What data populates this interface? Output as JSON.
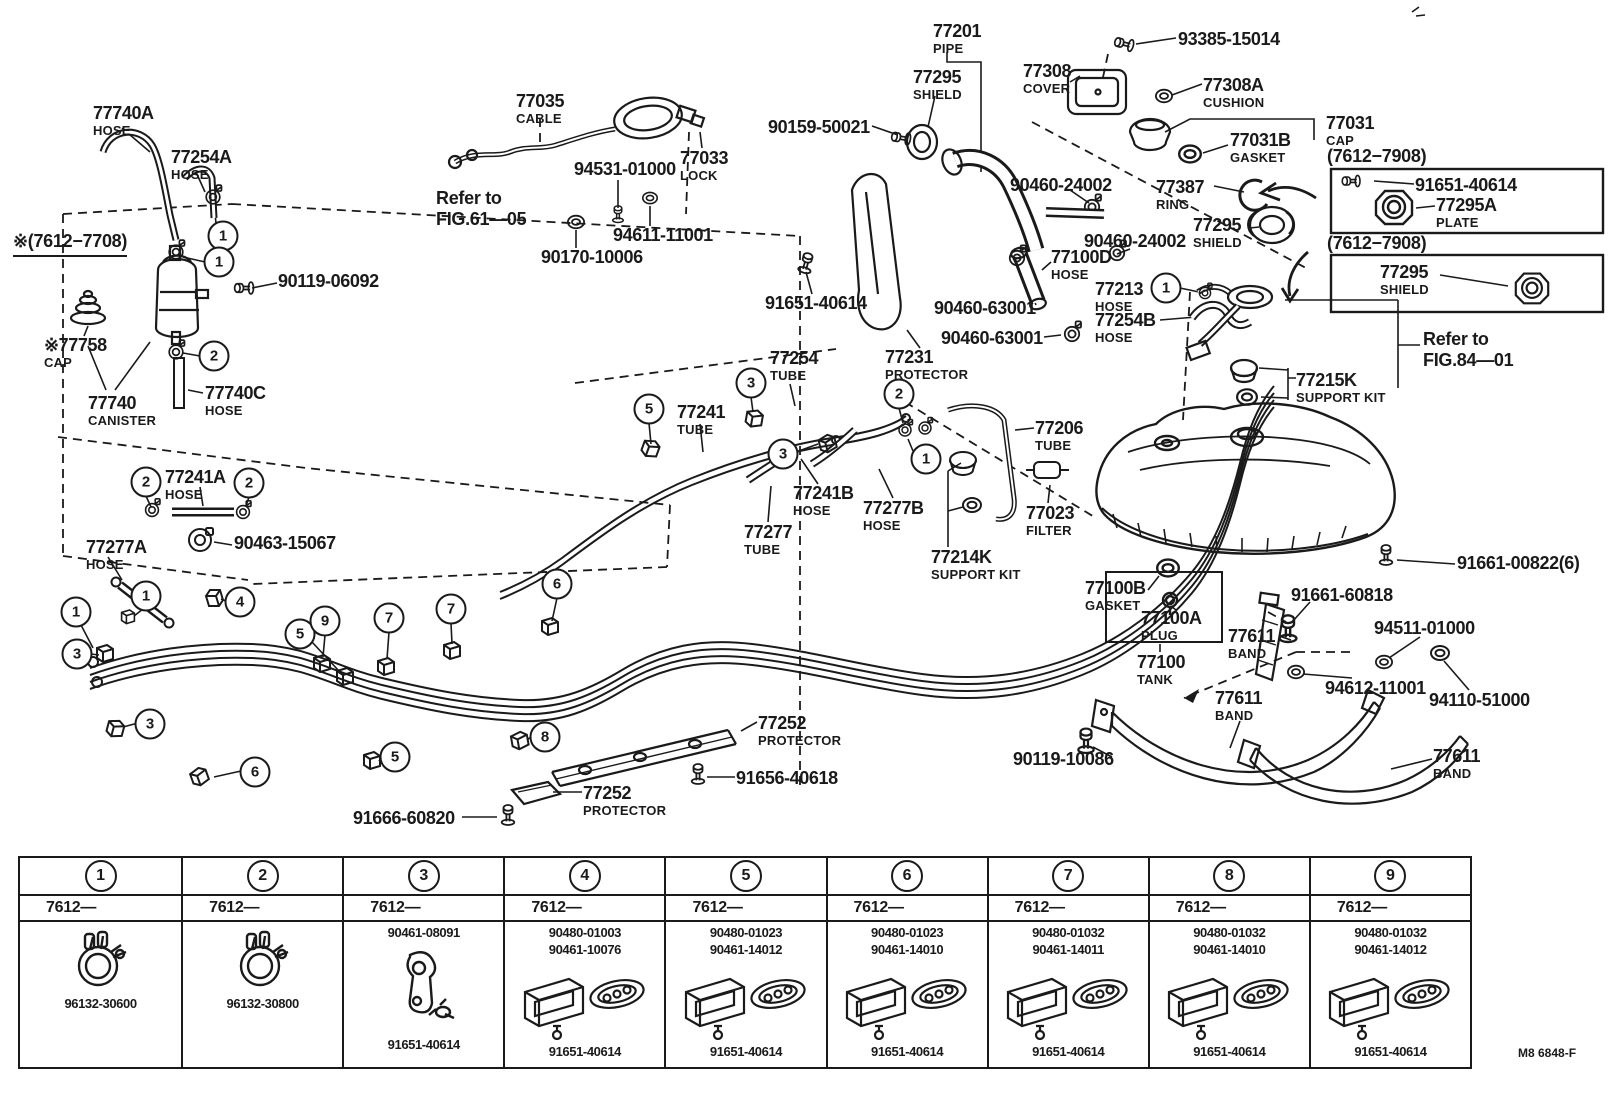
{
  "meta": {
    "figure_code": "M8 6848-F"
  },
  "colors": {
    "ink": "#1a1a1a",
    "background": "#ffffff"
  },
  "notes": [
    {
      "lines": [
        "※(7612−7708)"
      ],
      "x": 13,
      "y": 231,
      "underline": true
    },
    {
      "lines": [
        "Refer to",
        "FIG.61—05"
      ],
      "x": 436,
      "y": 188,
      "underline": false
    },
    {
      "lines": [
        "Refer to",
        "FIG.84—01"
      ],
      "x": 1423,
      "y": 329,
      "underline": false
    },
    {
      "lines": [
        "(7612−7908)"
      ],
      "x": 1327,
      "y": 146,
      "underline": false
    },
    {
      "lines": [
        "(7612−7908)"
      ],
      "x": 1327,
      "y": 233,
      "underline": false
    }
  ],
  "callouts": [
    {
      "n": "77740A",
      "t": "HOSE",
      "x": 93,
      "y": 104
    },
    {
      "n": "77254A",
      "t": "HOSE",
      "x": 171,
      "y": 148
    },
    {
      "n": "90119-06092",
      "t": "",
      "x": 278,
      "y": 272
    },
    {
      "n": "※77758",
      "t": "CAP",
      "x": 44,
      "y": 336
    },
    {
      "n": "77740",
      "t": "CANISTER",
      "x": 88,
      "y": 394
    },
    {
      "n": "77740C",
      "t": "HOSE",
      "x": 205,
      "y": 384
    },
    {
      "n": "77241A",
      "t": "HOSE",
      "x": 165,
      "y": 468
    },
    {
      "n": "90463-15067",
      "t": "",
      "x": 234,
      "y": 534
    },
    {
      "n": "77277A",
      "t": "HOSE",
      "x": 86,
      "y": 538
    },
    {
      "n": "77035",
      "t": "CABLE",
      "x": 516,
      "y": 92
    },
    {
      "n": "94531-01000",
      "t": "",
      "x": 574,
      "y": 160
    },
    {
      "n": "77033",
      "t": "LOCK",
      "x": 680,
      "y": 149
    },
    {
      "n": "94611-11001",
      "t": "",
      "x": 613,
      "y": 226
    },
    {
      "n": "90170-10006",
      "t": "",
      "x": 541,
      "y": 248
    },
    {
      "n": "77201",
      "t": "PIPE",
      "x": 933,
      "y": 22
    },
    {
      "n": "77295",
      "t": "SHIELD",
      "x": 913,
      "y": 68
    },
    {
      "n": "90159-50021",
      "t": "",
      "x": 768,
      "y": 118
    },
    {
      "n": "77308",
      "t": "COVER",
      "x": 1023,
      "y": 62
    },
    {
      "n": "93385-15014",
      "t": "",
      "x": 1178,
      "y": 30
    },
    {
      "n": "77308A",
      "t": "CUSHION",
      "x": 1203,
      "y": 76
    },
    {
      "n": "77031",
      "t": "CAP",
      "x": 1326,
      "y": 114
    },
    {
      "n": "77031B",
      "t": "GASKET",
      "x": 1230,
      "y": 131
    },
    {
      "n": "91651-40614",
      "t": "",
      "x": 1415,
      "y": 176
    },
    {
      "n": "77295A",
      "t": "PLATE",
      "x": 1436,
      "y": 196
    },
    {
      "n": "77387",
      "t": "RING",
      "x": 1156,
      "y": 178
    },
    {
      "n": "77295",
      "t": "SHIELD",
      "x": 1193,
      "y": 216
    },
    {
      "n": "77295",
      "t": "SHIELD",
      "x": 1380,
      "y": 263
    },
    {
      "n": "90460-24002",
      "t": "",
      "x": 1010,
      "y": 176
    },
    {
      "n": "90460-24002",
      "t": "",
      "x": 1084,
      "y": 232
    },
    {
      "n": "77100D",
      "t": "HOSE",
      "x": 1051,
      "y": 248
    },
    {
      "n": "77213",
      "t": "HOSE",
      "x": 1095,
      "y": 280
    },
    {
      "n": "77254B",
      "t": "HOSE",
      "x": 1095,
      "y": 311
    },
    {
      "n": "91651-40614",
      "t": "",
      "x": 765,
      "y": 294
    },
    {
      "n": "90460-63001",
      "t": "",
      "x": 934,
      "y": 299
    },
    {
      "n": "90460-63001",
      "t": "",
      "x": 941,
      "y": 329
    },
    {
      "n": "77231",
      "t": "PROTECTOR",
      "x": 885,
      "y": 348
    },
    {
      "n": "77215K",
      "t": "SUPPORT KIT",
      "x": 1296,
      "y": 371
    },
    {
      "n": "77254",
      "t": "TUBE",
      "x": 770,
      "y": 349
    },
    {
      "n": "77241",
      "t": "TUBE",
      "x": 677,
      "y": 403
    },
    {
      "n": "77206",
      "t": "TUBE",
      "x": 1035,
      "y": 419
    },
    {
      "n": "77241B",
      "t": "HOSE",
      "x": 793,
      "y": 484
    },
    {
      "n": "77277B",
      "t": "HOSE",
      "x": 863,
      "y": 499
    },
    {
      "n": "77023",
      "t": "FILTER",
      "x": 1026,
      "y": 504
    },
    {
      "n": "77277",
      "t": "TUBE",
      "x": 744,
      "y": 523
    },
    {
      "n": "77214K",
      "t": "SUPPORT KIT",
      "x": 931,
      "y": 548
    },
    {
      "n": "91661-00822(6)",
      "t": "",
      "x": 1457,
      "y": 554
    },
    {
      "n": "77100B",
      "t": "GASKET",
      "x": 1085,
      "y": 579
    },
    {
      "n": "77100A",
      "t": "PLUG",
      "x": 1141,
      "y": 609
    },
    {
      "n": "91661-60818",
      "t": "",
      "x": 1291,
      "y": 586
    },
    {
      "n": "77611",
      "t": "BAND",
      "x": 1228,
      "y": 627
    },
    {
      "n": "94511-01000",
      "t": "",
      "x": 1374,
      "y": 619
    },
    {
      "n": "77100",
      "t": "TANK",
      "x": 1137,
      "y": 653
    },
    {
      "n": "94612-11001",
      "t": "",
      "x": 1325,
      "y": 679
    },
    {
      "n": "94110-51000",
      "t": "",
      "x": 1429,
      "y": 691
    },
    {
      "n": "77611",
      "t": "BAND",
      "x": 1215,
      "y": 689
    },
    {
      "n": "90119-10086",
      "t": "",
      "x": 1013,
      "y": 750
    },
    {
      "n": "77611",
      "t": "BAND",
      "x": 1433,
      "y": 747
    },
    {
      "n": "77252",
      "t": "PROTECTOR",
      "x": 758,
      "y": 714
    },
    {
      "n": "91656-40618",
      "t": "",
      "x": 736,
      "y": 769
    },
    {
      "n": "77252",
      "t": "PROTECTOR",
      "x": 583,
      "y": 784
    },
    {
      "n": "91666-60820",
      "t": "",
      "x": 353,
      "y": 809
    }
  ],
  "circles": [
    {
      "n": "1",
      "x": 223,
      "y": 236
    },
    {
      "n": "1",
      "x": 219,
      "y": 262
    },
    {
      "n": "2",
      "x": 214,
      "y": 356
    },
    {
      "n": "2",
      "x": 146,
      "y": 482
    },
    {
      "n": "2",
      "x": 249,
      "y": 483
    },
    {
      "n": "1",
      "x": 146,
      "y": 596
    },
    {
      "n": "1",
      "x": 76,
      "y": 612
    },
    {
      "n": "3",
      "x": 77,
      "y": 654
    },
    {
      "n": "4",
      "x": 240,
      "y": 602
    },
    {
      "n": "5",
      "x": 300,
      "y": 634
    },
    {
      "n": "3",
      "x": 150,
      "y": 724
    },
    {
      "n": "9",
      "x": 325,
      "y": 621
    },
    {
      "n": "7",
      "x": 389,
      "y": 618
    },
    {
      "n": "7",
      "x": 451,
      "y": 609
    },
    {
      "n": "6",
      "x": 557,
      "y": 584
    },
    {
      "n": "6",
      "x": 255,
      "y": 772
    },
    {
      "n": "5",
      "x": 395,
      "y": 757
    },
    {
      "n": "8",
      "x": 545,
      "y": 737
    },
    {
      "n": "5",
      "x": 649,
      "y": 409
    },
    {
      "n": "3",
      "x": 751,
      "y": 383
    },
    {
      "n": "3",
      "x": 783,
      "y": 454
    },
    {
      "n": "2",
      "x": 899,
      "y": 394
    },
    {
      "n": "1",
      "x": 926,
      "y": 459
    },
    {
      "n": "1",
      "x": 1166,
      "y": 288
    }
  ],
  "table": {
    "columns": [
      {
        "no": "1",
        "period": "7612—",
        "glyph": "ring",
        "parts": [
          "96132-30600"
        ]
      },
      {
        "no": "2",
        "period": "7612—",
        "glyph": "ring",
        "parts": [
          "96132-30800"
        ]
      },
      {
        "no": "3",
        "period": "7612—",
        "glyph": "hook",
        "parts": [
          "90461-08091",
          "91651-40614"
        ]
      },
      {
        "no": "4",
        "period": "7612—",
        "glyph": "channel",
        "parts": [
          "90480-01003",
          "90461-10076",
          "91651-40614"
        ]
      },
      {
        "no": "5",
        "period": "7612—",
        "glyph": "channel",
        "parts": [
          "90480-01023",
          "90461-14012",
          "91651-40614"
        ]
      },
      {
        "no": "6",
        "period": "7612—",
        "glyph": "channel",
        "parts": [
          "90480-01023",
          "90461-14010",
          "91651-40614"
        ]
      },
      {
        "no": "7",
        "period": "7612—",
        "glyph": "channel",
        "parts": [
          "90480-01032",
          "90461-14011",
          "91651-40614"
        ]
      },
      {
        "no": "8",
        "period": "7612—",
        "glyph": "channel",
        "parts": [
          "90480-01032",
          "90461-14010",
          "91651-40614"
        ]
      },
      {
        "no": "9",
        "period": "7612—",
        "glyph": "channel",
        "parts": [
          "90480-01032",
          "90461-14012",
          "91651-40614"
        ]
      }
    ]
  }
}
